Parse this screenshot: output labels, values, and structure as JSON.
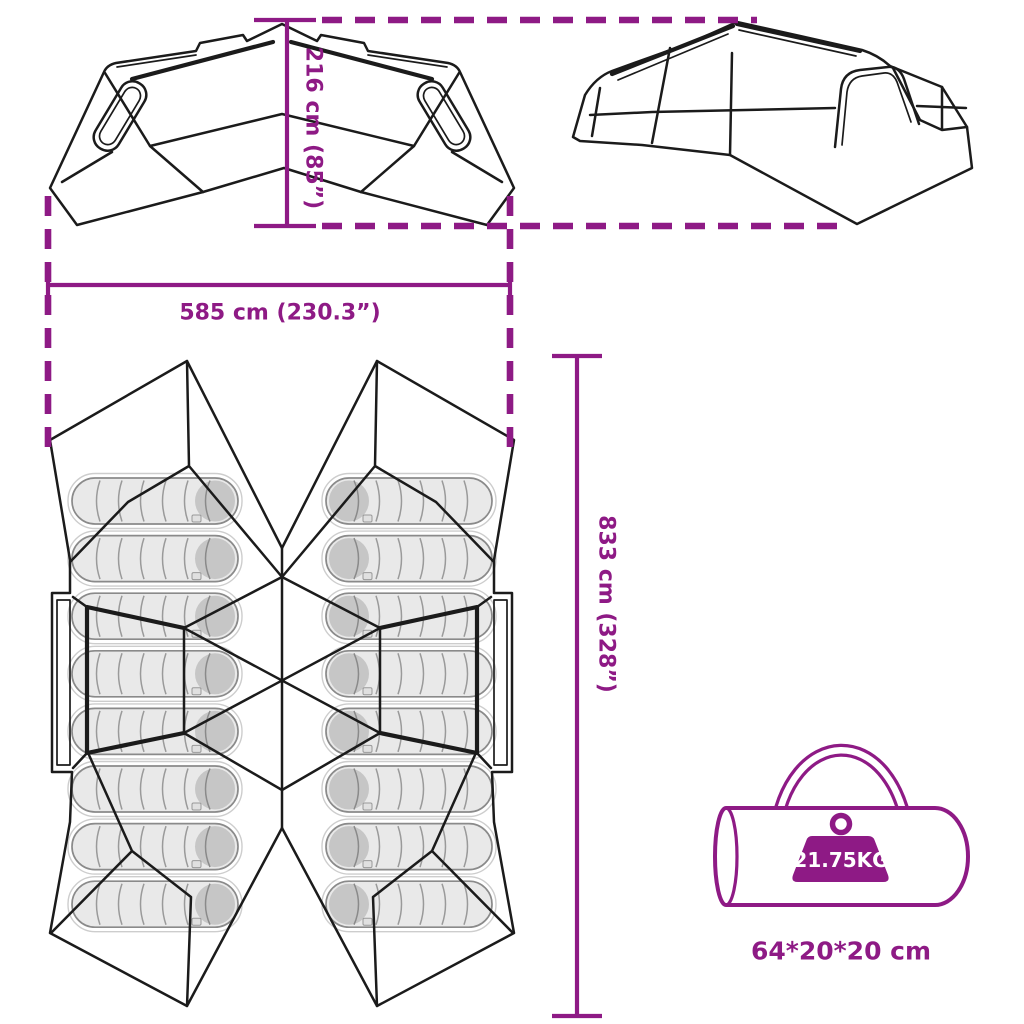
{
  "page": {
    "type": "product-dimension-diagram",
    "background": "#FFFFFF"
  },
  "colors": {
    "accent": "#8E1A85",
    "drawing_outline": "#1B1B1B",
    "sleeping_bag_fill": "#E9E9E9",
    "sleeping_bag_cap": "#C6C6C6",
    "sleeping_bag_outline": "#8A8A8A",
    "weight_label_text": "#FFFFFF"
  },
  "labels": {
    "height": "216 cm (85”)",
    "width": "585 cm (230.3”)",
    "depth": "833 cm (328”)",
    "weight": "21.75KG",
    "packed_size": "64*20*20 cm"
  },
  "figures": {
    "side_view": "tent side view",
    "perspective_view": "tent perspective view",
    "floor_plan": "tent floor plan with sleeping bags",
    "sleeping_bag_count": 16,
    "carry_bag": "carry bag with handle",
    "weight_icon": "weight on carry bag"
  },
  "icons": {
    "weight-icon": "solid trapezoid weight with ring",
    "carry-bag-icon": "cylindrical duffel bag outline with arch handle"
  }
}
